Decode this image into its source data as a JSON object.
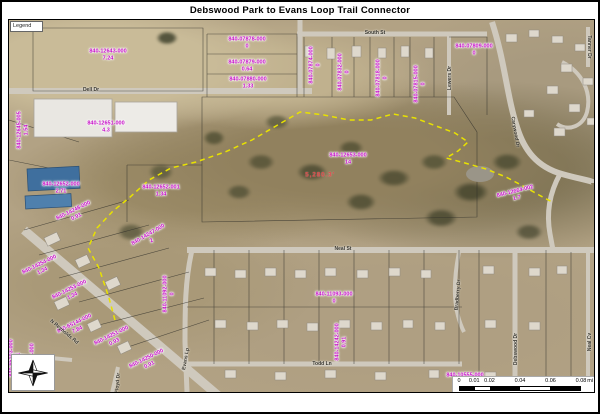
{
  "title": "Debswood Park to Evans Loop Trail Connector",
  "legend": {
    "label": "Legend"
  },
  "colors": {
    "parcel_label": "#c50cc5",
    "trail": "#e8e200",
    "measurement": "#e04343",
    "road": "#cfc9bd"
  },
  "measurement": {
    "text": "5,280.3'",
    "x": 318,
    "y": 173
  },
  "icons": {
    "north_arrow": "compass-rose-4point"
  },
  "parcels": [
    {
      "id": "840-12643-000",
      "acres": "7.24",
      "x": 106,
      "y": 53,
      "rot": 0
    },
    {
      "id": "840-07878-000",
      "acres": "0",
      "x": 245,
      "y": 41,
      "rot": 0
    },
    {
      "id": "840-07879-000",
      "acres": "0.64",
      "x": 245,
      "y": 64,
      "rot": 0
    },
    {
      "id": "840-07880-000",
      "acres": "1.33",
      "x": 246,
      "y": 81,
      "rot": 0
    },
    {
      "id": "840-07874-000",
      "acres": "0",
      "x": 313,
      "y": 63,
      "rot": -90
    },
    {
      "id": "840-07832-000",
      "acres": "0",
      "x": 342,
      "y": 70,
      "rot": -90
    },
    {
      "id": "840-07818-000",
      "acres": "0",
      "x": 380,
      "y": 76,
      "rot": -90
    },
    {
      "id": "840-07815-000",
      "acres": "0",
      "x": 418,
      "y": 82,
      "rot": -90
    },
    {
      "id": "840-07809-000",
      "acres": "0",
      "x": 472,
      "y": 48,
      "rot": 0
    },
    {
      "id": "840-12645-005",
      "acres": "1.54",
      "x": 21,
      "y": 128,
      "rot": -90
    },
    {
      "id": "840-12651-000",
      "acres": "4.3",
      "x": 104,
      "y": 125,
      "rot": 0
    },
    {
      "id": "840-12652-000",
      "acres": "2.71",
      "x": 59,
      "y": 186,
      "rot": 0
    },
    {
      "id": "840-12652-001",
      "acres": "1.34",
      "x": 159,
      "y": 189,
      "rot": 0
    },
    {
      "id": "840-12653-000",
      "acres": "14",
      "x": 346,
      "y": 157,
      "rot": 0
    },
    {
      "id": "840-12664-002",
      "acres": "1.7",
      "x": 514,
      "y": 193,
      "rot": -14
    },
    {
      "id": "840-14248-000",
      "acres": "0.91",
      "x": 73,
      "y": 212,
      "rot": -26
    },
    {
      "id": "840-14247-000",
      "acres": "2",
      "x": 148,
      "y": 236,
      "rot": -30
    },
    {
      "id": "840-14254-000",
      "acres": "1.34",
      "x": 39,
      "y": 266,
      "rot": -26
    },
    {
      "id": "840-14253-000",
      "acres": "1.34",
      "x": 69,
      "y": 291,
      "rot": -26
    },
    {
      "id": "840-65144-000",
      "acres": "7.84",
      "x": 74,
      "y": 325,
      "rot": -26
    },
    {
      "id": "840-14251-000",
      "acres": "0.93",
      "x": 111,
      "y": 337,
      "rot": -26
    },
    {
      "id": "840-14250-000",
      "acres": "0.91",
      "x": 146,
      "y": 360,
      "rot": -26
    },
    {
      "id": "840-65103-000",
      "acres": "0.91",
      "x": 13,
      "y": 356,
      "rot": -90
    },
    {
      "id": "840-65102-000",
      "acres": "0.93",
      "x": 34,
      "y": 360,
      "rot": -90
    },
    {
      "id": "840-11092-000",
      "acres": "0",
      "x": 167,
      "y": 292,
      "rot": -90
    },
    {
      "id": "840-11093-000",
      "acres": "0",
      "x": 332,
      "y": 296,
      "rot": 0
    },
    {
      "id": "840-14242-000",
      "acres": "0.91",
      "x": 339,
      "y": 340,
      "rot": -90
    },
    {
      "id": "840-10555-000",
      "acres": "0",
      "x": 463,
      "y": 377,
      "rot": 0
    }
  ],
  "streets": [
    {
      "name": "Dell Dr",
      "x": 89,
      "y": 88,
      "rot": 0
    },
    {
      "name": "South St",
      "x": 373,
      "y": 31,
      "rot": 0
    },
    {
      "name": "Lewers Dr",
      "x": 448,
      "y": 76,
      "rot": -90
    },
    {
      "name": "Carywood Dr",
      "x": 513,
      "y": 130,
      "rot": 80
    },
    {
      "name": "Tanner Dr",
      "x": 587,
      "y": 45,
      "rot": 90
    },
    {
      "name": "Neal St",
      "x": 341,
      "y": 247,
      "rot": 0
    },
    {
      "name": "Evans Lp",
      "x": 184,
      "y": 357,
      "rot": -80
    },
    {
      "name": "Todd Ln",
      "x": 320,
      "y": 362,
      "rot": 0
    },
    {
      "name": "N Reynolds Rd",
      "x": 62,
      "y": 330,
      "rot": 40
    },
    {
      "name": "Floyd Dr",
      "x": 116,
      "y": 381,
      "rot": -85
    },
    {
      "name": "Debswood Dr",
      "x": 514,
      "y": 347,
      "rot": -90
    },
    {
      "name": "Neal Cv",
      "x": 588,
      "y": 340,
      "rot": -90
    },
    {
      "name": "Bradberry Dr",
      "x": 456,
      "y": 293,
      "rot": -85
    }
  ],
  "trail": {
    "style": "dashed",
    "points": [
      [
        113,
        318
      ],
      [
        107,
        296
      ],
      [
        97,
        266
      ],
      [
        86,
        246
      ],
      [
        95,
        226
      ],
      [
        111,
        209
      ],
      [
        127,
        196
      ],
      [
        147,
        178
      ],
      [
        169,
        166
      ],
      [
        194,
        160
      ],
      [
        223,
        150
      ],
      [
        250,
        138
      ],
      [
        274,
        124
      ],
      [
        298,
        110
      ],
      [
        322,
        113
      ],
      [
        347,
        118
      ],
      [
        369,
        118
      ],
      [
        391,
        112
      ],
      [
        413,
        116
      ],
      [
        434,
        124
      ],
      [
        453,
        131
      ],
      [
        466,
        140
      ],
      [
        456,
        149
      ],
      [
        444,
        156
      ],
      [
        463,
        161
      ],
      [
        484,
        167
      ],
      [
        504,
        175
      ],
      [
        521,
        184
      ],
      [
        537,
        193
      ],
      [
        552,
        201
      ]
    ]
  },
  "scale_bar": {
    "ticks": [
      "0",
      "0.01",
      "0.02",
      "0.04",
      "0.06",
      "0.08"
    ],
    "unit": "mi"
  }
}
